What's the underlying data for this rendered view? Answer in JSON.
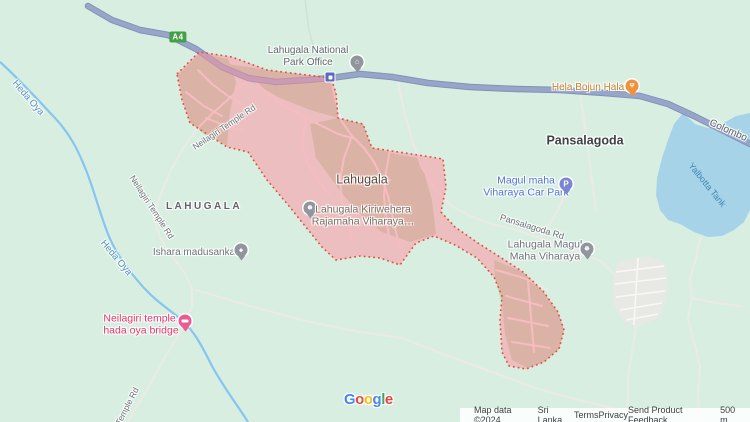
{
  "region": {
    "city_label": "Lahugala",
    "district_label": "LAHUGALA"
  },
  "poi": {
    "park_office_line1": "Lahugala National",
    "park_office_line2": "Park Office",
    "hela_bojun": "Hela Bojun Hala",
    "pansalagoda": "Pansalagoda",
    "kiriwehera_line1": "Lahugala Kiriwehera",
    "kiriwehera_line2": "Rajamaha Viharaya…",
    "carpark_line1": "Magul maha",
    "carpark_line2": "Viharaya Car Park",
    "magul_viharaya_line1": "Lahugala Magul",
    "magul_viharaya_line2": "Maha Viharaya",
    "ishara": "Ishara madusanka",
    "neilagiri_line1": "Neilagiri temple,",
    "neilagiri_line2": "hada oya bridge"
  },
  "roads": {
    "shield": "A4",
    "colombo": "Colombo",
    "pansalagoda_rd": "Pansalagoda Rd",
    "neilagiri_temple_rd": "Neilagiri Temple Rd",
    "temple_rd_partial": "Temple Rd"
  },
  "water": {
    "heda_oya": "Heda Oya",
    "yalbotta": "Yalbotta Tank"
  },
  "icons": {
    "parking_glyph": "P",
    "restaurant_glyph": "Ψ",
    "temple_glyph": "☸",
    "building_glyph": "⌂",
    "school_glyph": "◆"
  },
  "logo": {
    "l1": "G",
    "l2": "o",
    "l3": "o",
    "l4": "g",
    "l5": "l",
    "l6": "e"
  },
  "footer": {
    "map_data": "Map data ©2024",
    "country": "Sri Lanka",
    "terms": "Terms",
    "privacy": "Privacy",
    "feedback": "Send Product Feedback",
    "scale": "500 m"
  },
  "colors": {
    "land": "#d8eee1",
    "water": "#a6d3e8",
    "highway": "#97a6c8",
    "region_fill": "#f2c1c6",
    "region_border": "#e2503c",
    "logo_blue": "#4285F4",
    "logo_red": "#EA4335",
    "logo_yellow": "#FBBC05",
    "logo_green": "#34A853"
  }
}
